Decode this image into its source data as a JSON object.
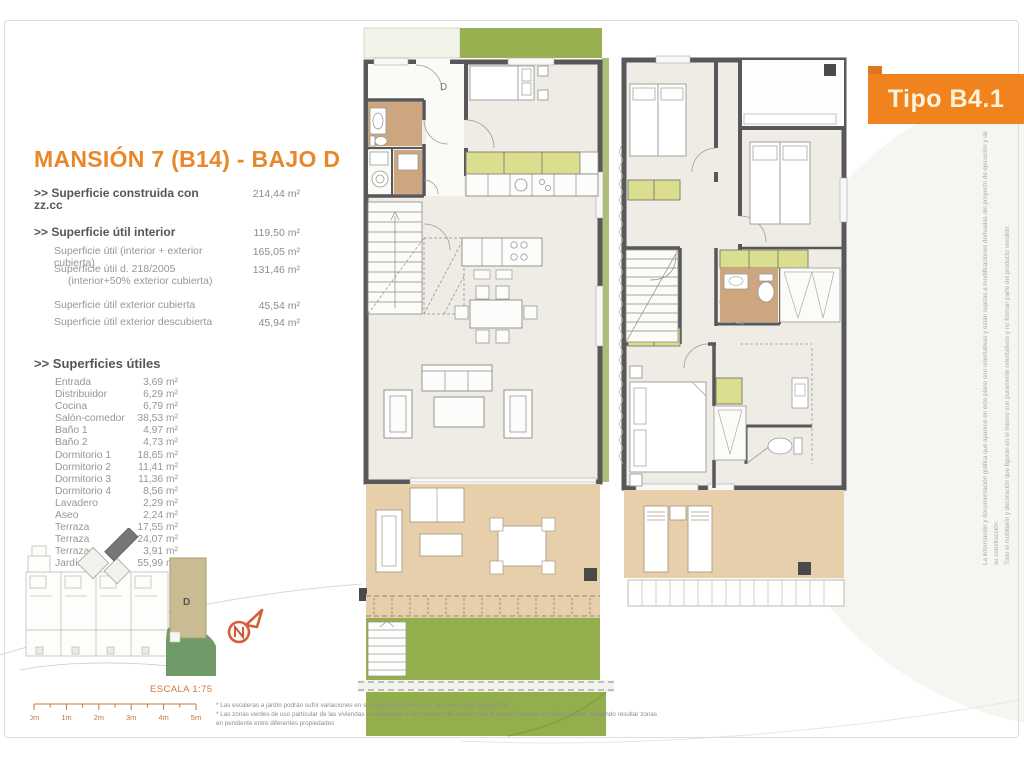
{
  "badge": {
    "label": "Tipo B4.1"
  },
  "title": "MANSIÓN 7 (B14) - BAJO D",
  "summary": {
    "rows": [
      {
        "label": ">> Superficie construida con zz.cc",
        "value": "214,44 m²"
      },
      {
        "label": ">> Superficie útil interior",
        "value": "119,50 m²"
      },
      {
        "label": "Superficie útil (interior + exterior cubierta)",
        "value": "165,05 m²"
      },
      {
        "label": "Superficie útil  d. 218/2005",
        "label2": "(interior+50% exterior cubierta)",
        "value": "131,46 m²"
      },
      {
        "label": "Superficie útil exterior cubierta",
        "value": "45,54 m²"
      },
      {
        "label": "Superficie útil exterior descubierta",
        "value": "45,94 m²"
      }
    ]
  },
  "rooms": {
    "header": ">> Superficies útiles",
    "items": [
      {
        "name": "Entrada",
        "value": "3,69 m²"
      },
      {
        "name": "Distribuidor",
        "value": "6,29 m²"
      },
      {
        "name": "Cocina",
        "value": "6,79 m²"
      },
      {
        "name": "Salón-comedor",
        "value": "38,53 m²"
      },
      {
        "name": "Baño 1",
        "value": "4,97 m²"
      },
      {
        "name": "Baño 2",
        "value": "4,73 m²"
      },
      {
        "name": "Dormitorio 1",
        "value": "18,65 m²"
      },
      {
        "name": "Dormitorio 2",
        "value": "11,41 m²"
      },
      {
        "name": "Dormitorio 3",
        "value": "11,36 m²"
      },
      {
        "name": "Dormitorio 4",
        "value": "8,56 m²"
      },
      {
        "name": "Lavadero",
        "value": "2,29 m²"
      },
      {
        "name": "Aseo",
        "value": "2,24 m²"
      },
      {
        "name": "Terraza",
        "value": "17,55 m²"
      },
      {
        "name": "Terraza",
        "value": "24,07 m²"
      },
      {
        "name": "Terraza",
        "value": "3,91 m²"
      },
      {
        "name": "Jardín",
        "value": "55,99 m²"
      }
    ]
  },
  "plan_labels": {
    "ground_unit": "D",
    "site_unit": "D"
  },
  "scale": {
    "label": "ESCALA 1:75",
    "ticks": [
      "0m",
      "1m",
      "2m",
      "3m",
      "4m",
      "5m"
    ]
  },
  "footnotes": {
    "line1": "* Las escaleras a jardín podrán sufrir variaciones en su longitud por temas de rasantes según topografía",
    "line2": "* Las zonas verdes de uso particular de las viviendas se adaptarán a las rasantes del terreno que el estudio marque en cada parcela, pudiendo resultar zonas en pendiente entre diferentes propiedades"
  },
  "disclaimer": {
    "line1": "La información y documentación gráfica que aparece en este plano son orientativas y están sujetas a modificaciones derivadas del proyecto de ejecución y de su construcción.",
    "line2": "Todo el mobiliario y decoración que figuran en el mismo son puramente orientativos y no forman parte del producto vendido."
  },
  "colors": {
    "accent_orange": "#F0831E",
    "wall_gray": "#58585A",
    "interior_beige": "#EFECE5",
    "wet_room_tan": "#CDA57E",
    "terrace_tan": "#E7CFAB",
    "wardrobe_yellow": "#DBDE8E",
    "garden_green": "#93AF4D",
    "siteplan_green": "#6F9A68",
    "unit_tan": "#C9BC93"
  }
}
